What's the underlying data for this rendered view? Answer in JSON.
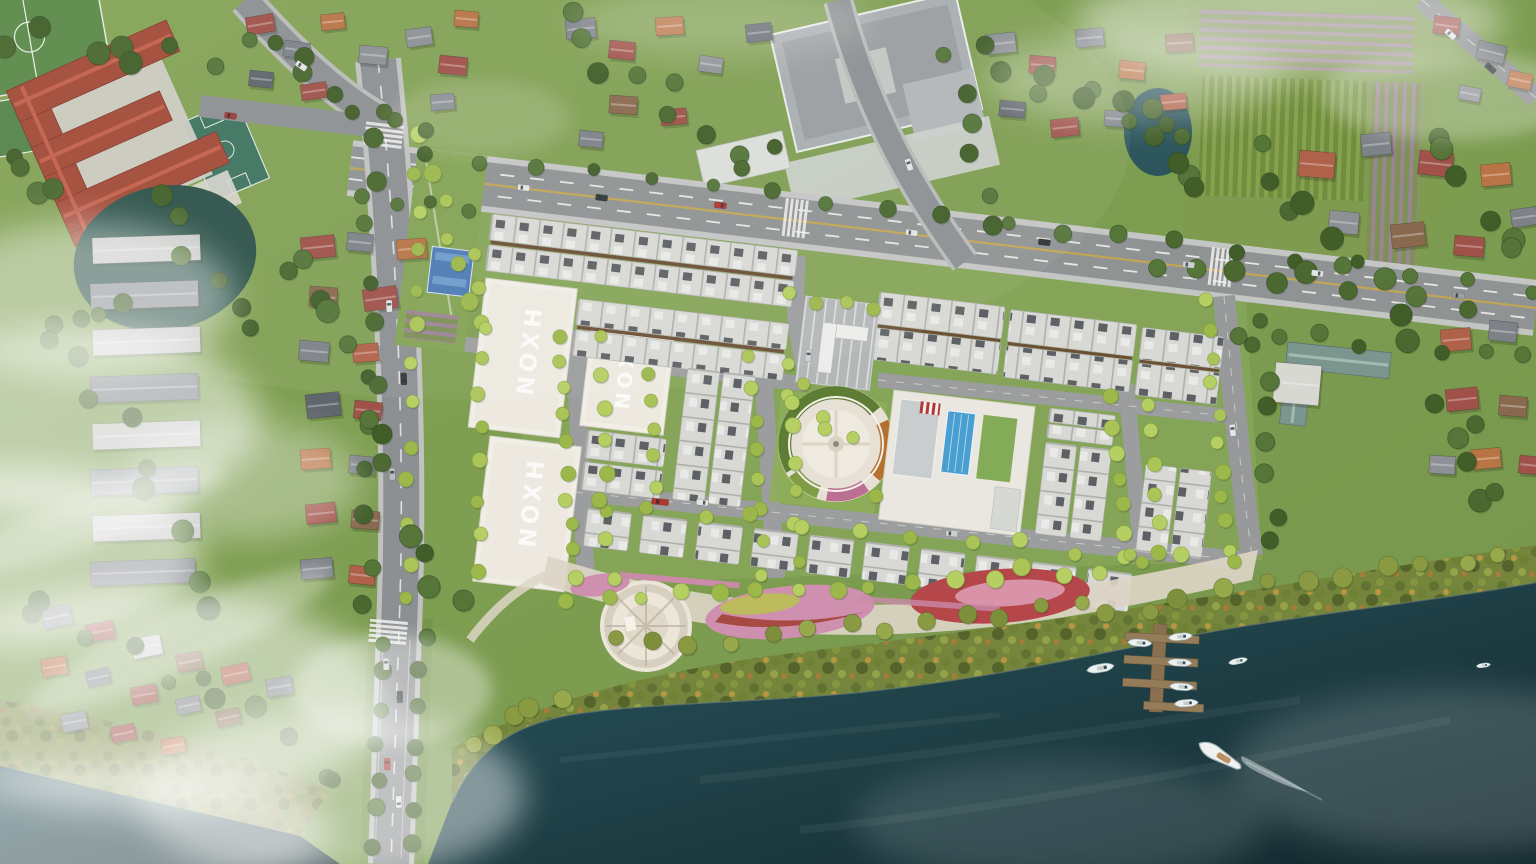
{
  "scene": {
    "title": "Aerial rendering of a riverside township master plan",
    "lot_labels": [
      "NOXH",
      "NOXH",
      "NOXH"
    ],
    "counts": {
      "noxh_lots": 3,
      "marina_boats": 6,
      "river_boats": 3
    },
    "palette": {
      "river": "#15333a",
      "land": "#7fa052",
      "asphalt": "#8b8e90",
      "townhouse_roof": "#d8d9d5",
      "school_roof": "#a34a38",
      "pool": "#4a9fd0",
      "tree_bright": "#abc457",
      "tree_dark": "#4a682f",
      "cloud": "#ffffff"
    }
  }
}
